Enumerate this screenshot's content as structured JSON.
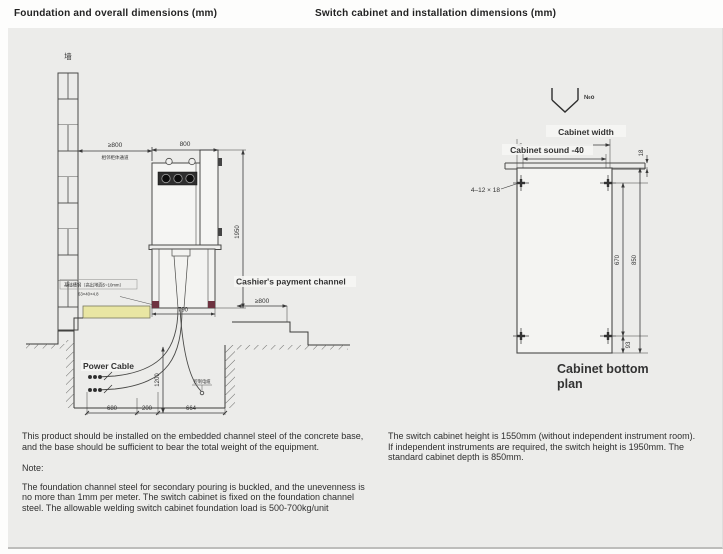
{
  "page": {
    "title_left": "Foundation and overall dimensions (mm)",
    "title_right": "Switch cabinet and installation dimensions (mm)"
  },
  "foundation_drawing": {
    "wall_label": "墙",
    "rear_clearance_dim": "≥800",
    "rear_clearance_note": "相邻柜体通道",
    "cabinet_width_dim": "800",
    "cabinet_height_dim": "1950",
    "base_width_dim": "790",
    "channel_steel_note": "基础槽钢（高出地面5~10mm）",
    "channel_steel_size": "63×40×4.8",
    "cashier_channel_label": "Cashier's payment channel",
    "front_clearance_dim": "≥800",
    "power_cable_label": "Power Cable",
    "control_cable_label": "控制电缆",
    "pit_depth_dim": "1200",
    "pit_dim_left": "680",
    "pit_dim_mid": "200",
    "pit_dim_right": "664"
  },
  "installation_drawing": {
    "hoist_mark_label": "№o",
    "cabinet_width_label": "Cabinet width",
    "cabinet_inner_label": "Cabinet sound -40",
    "mounting_holes_label": "4–12 × 18",
    "rail_height_dim": "18",
    "hole_span_dim": "670",
    "cabinet_depth_dim": "850",
    "hole_offset_dim": "93",
    "plan_title_line1": "Cabinet bottom",
    "plan_title_line2": "plan"
  },
  "notes_left": {
    "paragraph1": "This product should be installed on the embedded channel steel of the concrete base, and the base should be sufficient to bear the total weight of the equipment.",
    "note_label": "Note:",
    "paragraph2": "The foundation channel steel for secondary pouring is buckled, and the unevenness is no more than 1mm per meter. The switch cabinet is fixed on the foundation channel steel. The allowable welding switch cabinet foundation load is 500-700kg/unit"
  },
  "notes_right": {
    "paragraph1": "The switch cabinet height is 1550mm (without independent instrument room). If independent instruments are required, the switch height is 1950mm. The standard cabinet depth is 850mm."
  }
}
